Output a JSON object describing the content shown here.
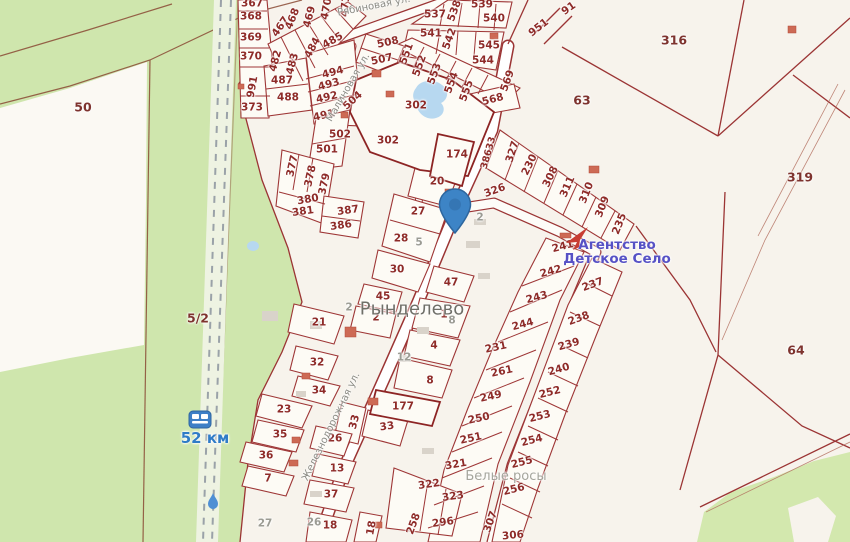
{
  "map": {
    "place_names": {
      "village": "Рынделево",
      "district": "Белые росы"
    },
    "poi": {
      "label": "Агентство\nДетское Село",
      "color": "#5651c5",
      "icon": "agency-arrow-icon"
    },
    "station": {
      "label": "52 км",
      "color": "#2f7cc7",
      "icon": "railway-station-icon"
    },
    "pin": {
      "x": 455,
      "y": 232,
      "color": "#3d84c6",
      "icon": "location-pin"
    },
    "road_code": "38633",
    "streets": [
      "Рябиновая ул.",
      "Малиновая ул.",
      "Железнодорожная ул."
    ],
    "colors": {
      "background": "#f7f3ec",
      "forest": "#cfe6ad",
      "parcel_fill": "#fdfbf5",
      "boundary_red": "#9b3434",
      "parcel_number": "#8e2b28",
      "gray_text": "#9b9b93",
      "water": "#b7d8f0",
      "building_red": "#cd6a55",
      "building_gray": "#d9d3ca",
      "railway_dash": "#9aa2a8"
    },
    "labels": [
      {
        "t": "367",
        "x": 252,
        "y": 4,
        "c": "p"
      },
      {
        "t": "368",
        "x": 251,
        "y": 17,
        "c": "p"
      },
      {
        "t": "369",
        "x": 251,
        "y": 38,
        "c": "p"
      },
      {
        "t": "370",
        "x": 251,
        "y": 57,
        "c": "p"
      },
      {
        "t": "991",
        "x": 253,
        "y": 87,
        "r": -80,
        "c": "p"
      },
      {
        "t": "373",
        "x": 252,
        "y": 108,
        "c": "p"
      },
      {
        "t": "467",
        "x": 281,
        "y": 27,
        "r": -55,
        "c": "p"
      },
      {
        "t": "468",
        "x": 293,
        "y": 19,
        "r": -68,
        "c": "p"
      },
      {
        "t": "469",
        "x": 310,
        "y": 17,
        "r": -75,
        "c": "p"
      },
      {
        "t": "470",
        "x": 327,
        "y": 9,
        "r": -80,
        "c": "p"
      },
      {
        "t": "471",
        "x": 346,
        "y": 6,
        "r": -85,
        "c": "p"
      },
      {
        "t": "482",
        "x": 276,
        "y": 61,
        "r": -75,
        "c": "p"
      },
      {
        "t": "483",
        "x": 293,
        "y": 64,
        "r": -75,
        "c": "p"
      },
      {
        "t": "484",
        "x": 313,
        "y": 48,
        "r": -62,
        "c": "p"
      },
      {
        "t": "485",
        "x": 333,
        "y": 41,
        "r": -30,
        "c": "p"
      },
      {
        "t": "487",
        "x": 282,
        "y": 81,
        "c": "p"
      },
      {
        "t": "488",
        "x": 288,
        "y": 98,
        "c": "p"
      },
      {
        "t": "494",
        "x": 333,
        "y": 73,
        "r": -15,
        "c": "p"
      },
      {
        "t": "493",
        "x": 329,
        "y": 85,
        "r": -15,
        "c": "p"
      },
      {
        "t": "492",
        "x": 327,
        "y": 98,
        "r": -13,
        "c": "p"
      },
      {
        "t": "491",
        "x": 324,
        "y": 116,
        "r": -13,
        "c": "p"
      },
      {
        "t": "504",
        "x": 353,
        "y": 101,
        "r": -42,
        "c": "p"
      },
      {
        "t": "502",
        "x": 340,
        "y": 135,
        "c": "p"
      },
      {
        "t": "501",
        "x": 327,
        "y": 150,
        "c": "p"
      },
      {
        "t": "377",
        "x": 293,
        "y": 166,
        "r": -78,
        "c": "p"
      },
      {
        "t": "378",
        "x": 311,
        "y": 176,
        "r": -78,
        "c": "p"
      },
      {
        "t": "379",
        "x": 325,
        "y": 184,
        "r": -78,
        "c": "p"
      },
      {
        "t": "380",
        "x": 308,
        "y": 200,
        "r": -10,
        "c": "p"
      },
      {
        "t": "381",
        "x": 303,
        "y": 212,
        "r": -8,
        "c": "p"
      },
      {
        "t": "387",
        "x": 348,
        "y": 211,
        "r": -8,
        "c": "p"
      },
      {
        "t": "386",
        "x": 341,
        "y": 226,
        "r": -8,
        "c": "p"
      },
      {
        "t": "508",
        "x": 388,
        "y": 43,
        "r": -12,
        "c": "p"
      },
      {
        "t": "507",
        "x": 382,
        "y": 60,
        "r": -12,
        "c": "p"
      },
      {
        "t": "537",
        "x": 435,
        "y": 15,
        "c": "p"
      },
      {
        "t": "538",
        "x": 455,
        "y": 11,
        "r": -70,
        "c": "p"
      },
      {
        "t": "539",
        "x": 482,
        "y": 5,
        "c": "p"
      },
      {
        "t": "540",
        "x": 494,
        "y": 19,
        "c": "p"
      },
      {
        "t": "541",
        "x": 431,
        "y": 34,
        "c": "p"
      },
      {
        "t": "542",
        "x": 450,
        "y": 39,
        "r": -70,
        "c": "p"
      },
      {
        "t": "545",
        "x": 489,
        "y": 46,
        "c": "p"
      },
      {
        "t": "544",
        "x": 483,
        "y": 61,
        "c": "p"
      },
      {
        "t": "551",
        "x": 407,
        "y": 54,
        "r": -70,
        "c": "p"
      },
      {
        "t": "552",
        "x": 420,
        "y": 66,
        "r": -70,
        "c": "p"
      },
      {
        "t": "553",
        "x": 435,
        "y": 74,
        "r": -70,
        "c": "p"
      },
      {
        "t": "554",
        "x": 452,
        "y": 83,
        "r": -70,
        "c": "p"
      },
      {
        "t": "555",
        "x": 467,
        "y": 91,
        "r": -70,
        "c": "p"
      },
      {
        "t": "569",
        "x": 508,
        "y": 81,
        "r": -70,
        "c": "p"
      },
      {
        "t": "568",
        "x": 493,
        "y": 100,
        "r": -15,
        "c": "p"
      },
      {
        "t": "302",
        "x": 416,
        "y": 106,
        "c": "p"
      },
      {
        "t": "302",
        "x": 388,
        "y": 141,
        "c": "p"
      },
      {
        "t": "91",
        "x": 569,
        "y": 9,
        "r": -35,
        "c": "p"
      },
      {
        "t": "951",
        "x": 539,
        "y": 28,
        "r": -38,
        "c": "p"
      },
      {
        "t": "174",
        "x": 457,
        "y": 155,
        "c": "p"
      },
      {
        "t": "38633",
        "x": 489,
        "y": 153,
        "r": -74,
        "c": "rc"
      },
      {
        "t": "326",
        "x": 495,
        "y": 191,
        "r": -20,
        "c": "p"
      },
      {
        "t": "327",
        "x": 513,
        "y": 152,
        "r": -72,
        "c": "p"
      },
      {
        "t": "230",
        "x": 530,
        "y": 165,
        "r": -64,
        "c": "p"
      },
      {
        "t": "308",
        "x": 551,
        "y": 177,
        "r": -64,
        "c": "p"
      },
      {
        "t": "311",
        "x": 568,
        "y": 187,
        "r": -66,
        "c": "p"
      },
      {
        "t": "310",
        "x": 587,
        "y": 193,
        "r": -68,
        "c": "p"
      },
      {
        "t": "309",
        "x": 603,
        "y": 207,
        "r": -68,
        "c": "p"
      },
      {
        "t": "235",
        "x": 620,
        "y": 224,
        "r": -68,
        "c": "p"
      },
      {
        "t": "241",
        "x": 563,
        "y": 247,
        "r": -15,
        "c": "p"
      },
      {
        "t": "242",
        "x": 551,
        "y": 272,
        "r": -15,
        "c": "p"
      },
      {
        "t": "243",
        "x": 537,
        "y": 298,
        "r": -15,
        "c": "p"
      },
      {
        "t": "244",
        "x": 523,
        "y": 325,
        "r": -15,
        "c": "p"
      },
      {
        "t": "231",
        "x": 496,
        "y": 348,
        "r": -12,
        "c": "p"
      },
      {
        "t": "261",
        "x": 502,
        "y": 372,
        "r": -12,
        "c": "p"
      },
      {
        "t": "249",
        "x": 491,
        "y": 397,
        "r": -12,
        "c": "p"
      },
      {
        "t": "250",
        "x": 479,
        "y": 419,
        "r": -12,
        "c": "p"
      },
      {
        "t": "251",
        "x": 471,
        "y": 439,
        "r": -12,
        "c": "p"
      },
      {
        "t": "321",
        "x": 456,
        "y": 465,
        "r": -10,
        "c": "p"
      },
      {
        "t": "322",
        "x": 429,
        "y": 485,
        "r": -8,
        "c": "p"
      },
      {
        "t": "323",
        "x": 453,
        "y": 497,
        "r": -8,
        "c": "p"
      },
      {
        "t": "296",
        "x": 443,
        "y": 523,
        "r": -8,
        "c": "p"
      },
      {
        "t": "258",
        "x": 414,
        "y": 524,
        "r": -70,
        "c": "p"
      },
      {
        "t": "307",
        "x": 491,
        "y": 522,
        "r": -70,
        "c": "p"
      },
      {
        "t": "306",
        "x": 513,
        "y": 536,
        "r": -5,
        "c": "p"
      },
      {
        "t": "237",
        "x": 593,
        "y": 285,
        "r": -20,
        "c": "p"
      },
      {
        "t": "238",
        "x": 579,
        "y": 319,
        "r": -20,
        "c": "p"
      },
      {
        "t": "239",
        "x": 569,
        "y": 345,
        "r": -16,
        "c": "p"
      },
      {
        "t": "240",
        "x": 559,
        "y": 370,
        "r": -16,
        "c": "p"
      },
      {
        "t": "252",
        "x": 550,
        "y": 393,
        "r": -14,
        "c": "p"
      },
      {
        "t": "253",
        "x": 540,
        "y": 417,
        "r": -14,
        "c": "p"
      },
      {
        "t": "254",
        "x": 532,
        "y": 441,
        "r": -14,
        "c": "p"
      },
      {
        "t": "255",
        "x": 522,
        "y": 463,
        "r": -14,
        "c": "p"
      },
      {
        "t": "256",
        "x": 514,
        "y": 490,
        "r": -14,
        "c": "p"
      },
      {
        "t": "20",
        "x": 437,
        "y": 182,
        "c": "p"
      },
      {
        "t": "27",
        "x": 418,
        "y": 212,
        "c": "p"
      },
      {
        "t": "28",
        "x": 401,
        "y": 239,
        "c": "p"
      },
      {
        "t": "30",
        "x": 397,
        "y": 270,
        "c": "p"
      },
      {
        "t": "47",
        "x": 451,
        "y": 283,
        "c": "p"
      },
      {
        "t": "45",
        "x": 383,
        "y": 297,
        "c": "p"
      },
      {
        "t": "2",
        "x": 376,
        "y": 318,
        "c": "p"
      },
      {
        "t": "1",
        "x": 444,
        "y": 315,
        "c": "p"
      },
      {
        "t": "4",
        "x": 434,
        "y": 346,
        "c": "p"
      },
      {
        "t": "8",
        "x": 430,
        "y": 381,
        "c": "p"
      },
      {
        "t": "177",
        "x": 403,
        "y": 407,
        "c": "p"
      },
      {
        "t": "33",
        "x": 355,
        "y": 422,
        "r": -75,
        "c": "p"
      },
      {
        "t": "33",
        "x": 387,
        "y": 427,
        "r": -8,
        "c": "p"
      },
      {
        "t": "32",
        "x": 317,
        "y": 363,
        "c": "p"
      },
      {
        "t": "34",
        "x": 319,
        "y": 391,
        "c": "p"
      },
      {
        "t": "23",
        "x": 284,
        "y": 410,
        "c": "p"
      },
      {
        "t": "35",
        "x": 280,
        "y": 435,
        "c": "p"
      },
      {
        "t": "36",
        "x": 266,
        "y": 456,
        "c": "p"
      },
      {
        "t": "7",
        "x": 268,
        "y": 479,
        "c": "p"
      },
      {
        "t": "26",
        "x": 335,
        "y": 439,
        "c": "p"
      },
      {
        "t": "13",
        "x": 337,
        "y": 469,
        "c": "p"
      },
      {
        "t": "37",
        "x": 331,
        "y": 495,
        "c": "p"
      },
      {
        "t": "18",
        "x": 330,
        "y": 526,
        "c": "p"
      },
      {
        "t": "18",
        "x": 372,
        "y": 528,
        "r": -80,
        "c": "p"
      },
      {
        "t": "21",
        "x": 319,
        "y": 323,
        "c": "p"
      },
      {
        "t": "50",
        "x": 83,
        "y": 107,
        "c": "pl"
      },
      {
        "t": "5/2",
        "x": 198,
        "y": 318,
        "c": "pl"
      },
      {
        "t": "316",
        "x": 674,
        "y": 40,
        "c": "pl"
      },
      {
        "t": "63",
        "x": 582,
        "y": 100,
        "c": "pl"
      },
      {
        "t": "319",
        "x": 800,
        "y": 177,
        "c": "pl"
      },
      {
        "t": "64",
        "x": 796,
        "y": 350,
        "c": "pl"
      },
      {
        "t": "2",
        "x": 349,
        "y": 308,
        "c": "g"
      },
      {
        "t": "2",
        "x": 480,
        "y": 218,
        "c": "g"
      },
      {
        "t": "5",
        "x": 419,
        "y": 243,
        "c": "g"
      },
      {
        "t": "8",
        "x": 452,
        "y": 321,
        "c": "g"
      },
      {
        "t": "12",
        "x": 404,
        "y": 358,
        "c": "g"
      },
      {
        "t": "26",
        "x": 314,
        "y": 523,
        "c": "g"
      },
      {
        "t": "27",
        "x": 265,
        "y": 524,
        "c": "g"
      },
      {
        "t": "Рябиновая ул.",
        "x": 374,
        "y": 7,
        "r": -11,
        "c": "s"
      },
      {
        "t": "Малиновая ул.",
        "x": 349,
        "y": 88,
        "r": -60,
        "c": "s"
      },
      {
        "t": "Железнодорожная ул.",
        "x": 332,
        "y": 427,
        "r": -64,
        "c": "s"
      },
      {
        "t": "Рынделево",
        "x": 412,
        "y": 310,
        "c": "pn"
      },
      {
        "t": "Белые росы",
        "x": 506,
        "y": 477,
        "c": "pg"
      },
      {
        "t": "Агентство\nДетское Село",
        "x": 617,
        "y": 252,
        "c": "poi"
      },
      {
        "t": "52 км",
        "x": 205,
        "y": 439,
        "c": "st"
      }
    ]
  }
}
